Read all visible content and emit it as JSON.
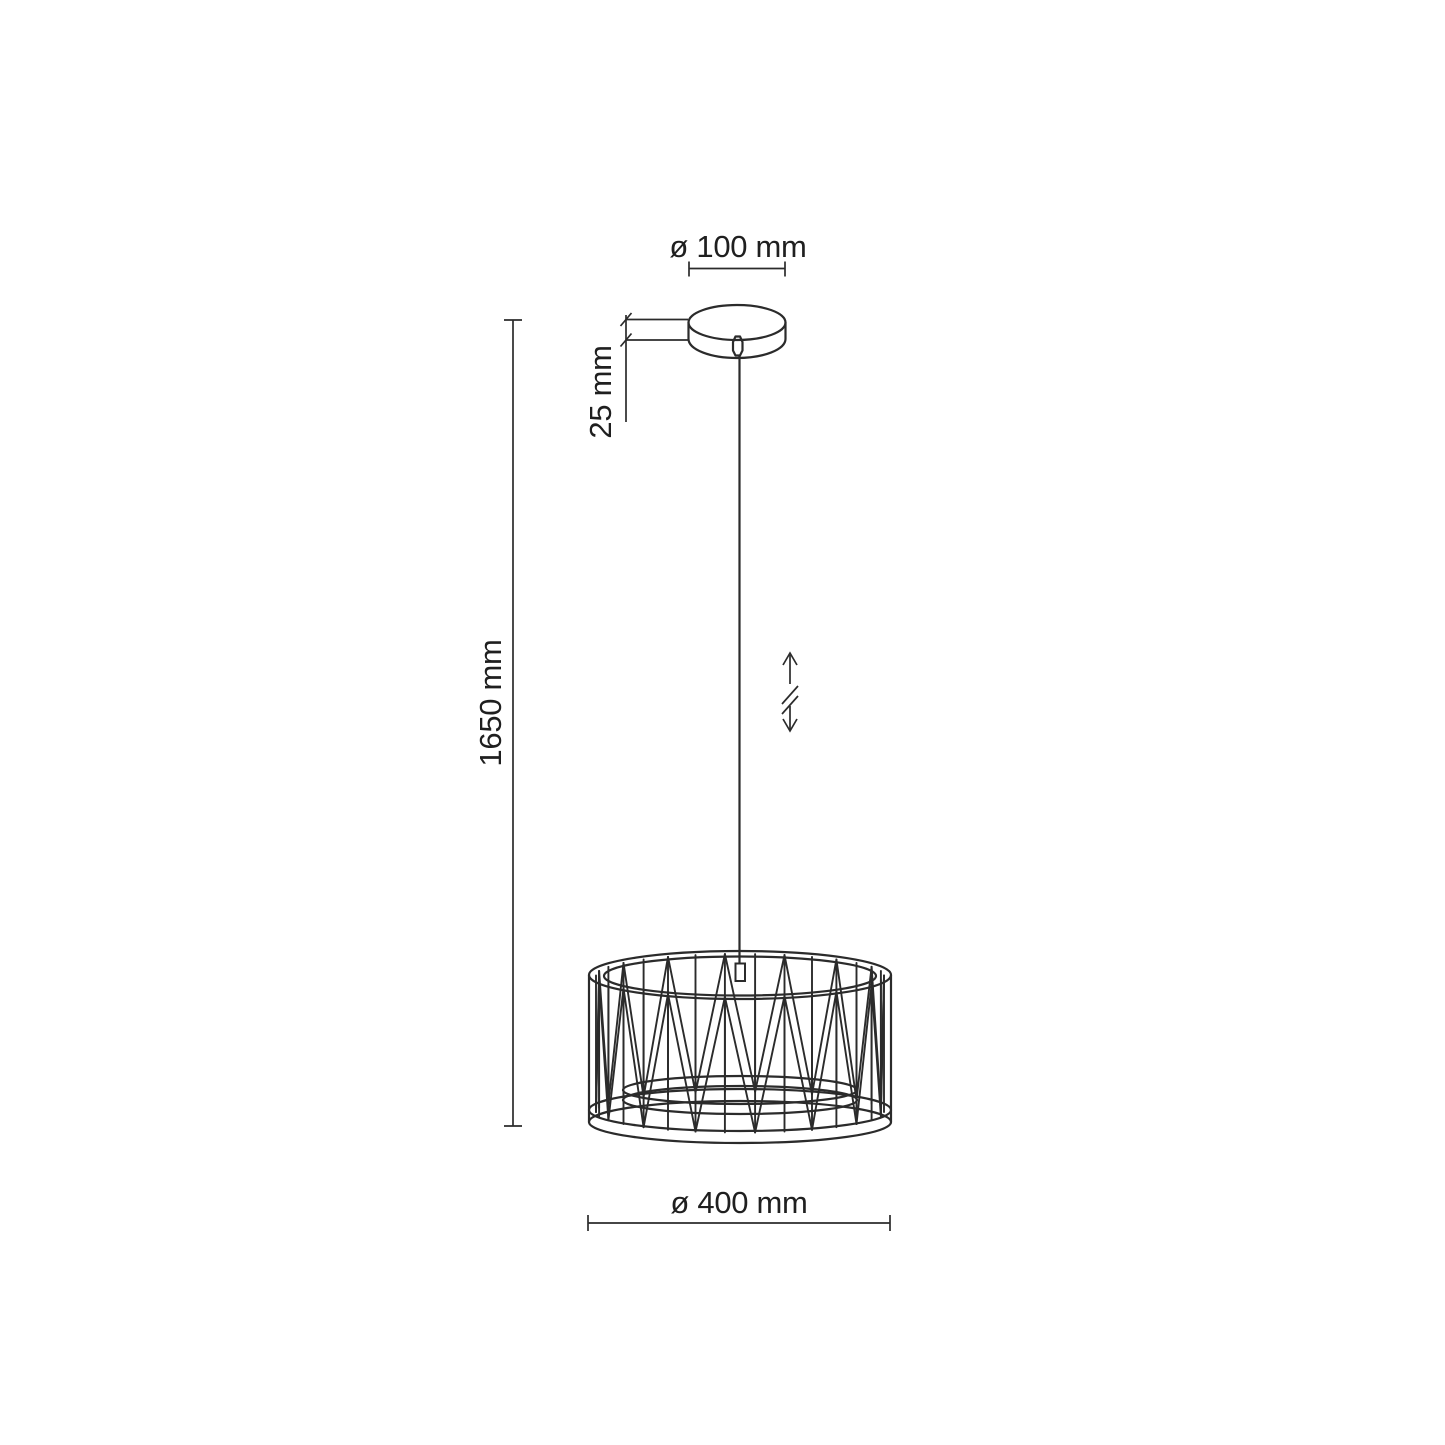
{
  "drawing": {
    "type": "pendant-lamp-technical-dimension-drawing",
    "labels": {
      "canopy_diameter": "ø 100 mm",
      "canopy_height": "25 mm",
      "overall_height": "1650 mm",
      "shade_diameter": "ø 400 mm"
    },
    "symbols": {
      "height_adjustable": "double-headed-vertical-arrow-with-break"
    },
    "colors": {
      "line": "#2b2b2b",
      "text": "#1f1f1f",
      "background": "#ffffff"
    }
  }
}
